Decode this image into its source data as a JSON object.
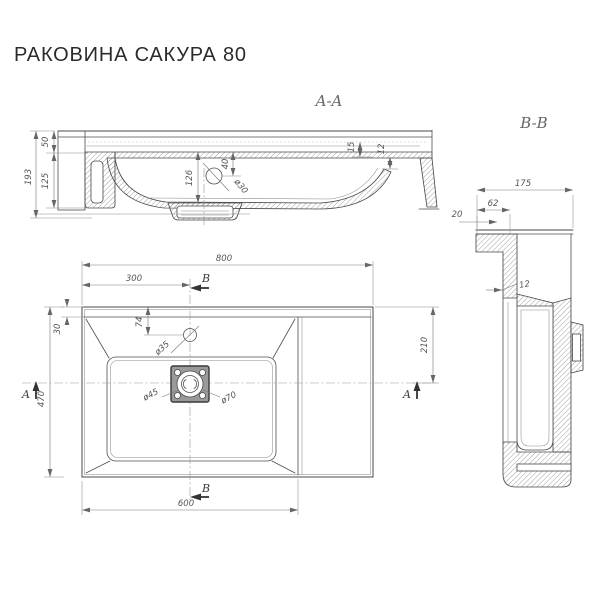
{
  "title": "РАКОВИНА САКУРА 80",
  "colors": {
    "line": "#4a4a4a",
    "dim_line": "#787878",
    "dim_text": "#555555",
    "title_text": "#2b2b2b"
  },
  "section_aa": {
    "label": "A-A",
    "dim_total_height": "193",
    "dim_top_height": "50",
    "dim_bottom_height": "125",
    "dim_bowl_depth": "126",
    "dim_overflow_offset": "40",
    "dim_overflow_dia": "ø30",
    "dim_step": "15",
    "dim_wall": "12"
  },
  "section_bb": {
    "label": "B-B",
    "dim_depth": "175",
    "dim_ledge": "62",
    "dim_edge": "20",
    "dim_wall": "12"
  },
  "plan": {
    "dim_width": "800",
    "dim_section_offset": "300",
    "dim_rim": "30",
    "dim_depth": "470",
    "dim_faucet_offset": "74",
    "dim_faucet_dia": "ø35",
    "dim_drain_inner": "ø45",
    "dim_drain_outer": "ø70",
    "dim_right_offset": "210",
    "dim_basin_width": "600",
    "marker_a": "A",
    "marker_b": "B"
  }
}
